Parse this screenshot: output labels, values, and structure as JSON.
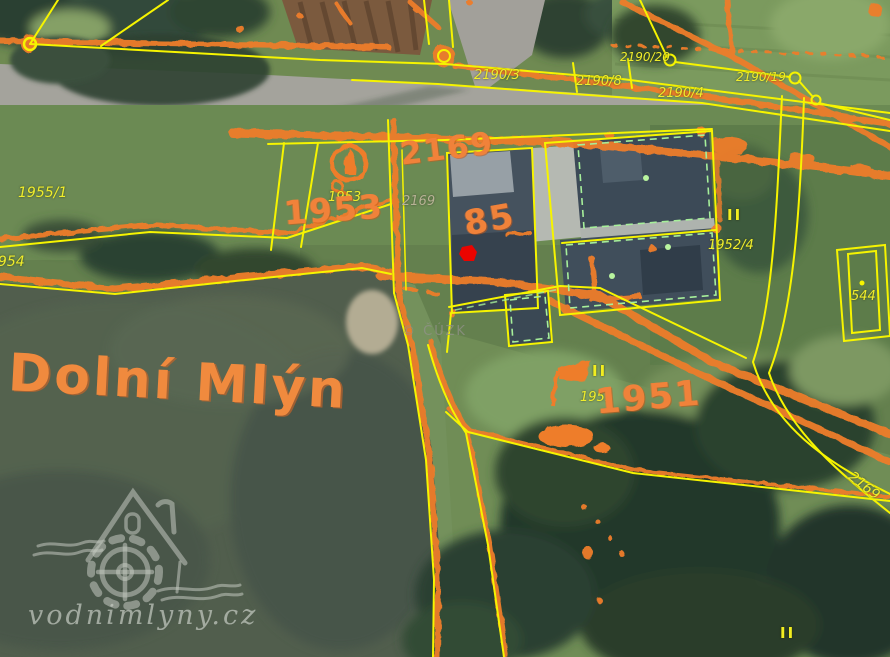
{
  "map": {
    "place_name": "Dolní Mlýn",
    "copyright": "© ČÚZK",
    "site_watermark": "vodnimlyny.cz",
    "parcels": {
      "p2190_3": "2190/3",
      "p2190_8": "2190/8",
      "p2190_20": "2190/20",
      "p2190_19": "2190/19",
      "p2190_4": "2190/4",
      "p1955_1": "1955/1",
      "p1954": "1954",
      "p1953_small": "1953",
      "p1953_big": "1953",
      "p2169_big": "2169",
      "p2169_small": "2169",
      "p2169_edge": "2169",
      "p1952_4": "1952/4",
      "p544": "544",
      "p1951_small": "1951",
      "p1951_big": "1951",
      "building_85": "85"
    },
    "land_use_marks": {
      "mark1": "II",
      "mark2": "II",
      "mark3": "II"
    },
    "icons": {
      "red_marker": "selected-location-dot",
      "boundary_circle": "cadastral-boundary-point",
      "monument": "old-map-monument-symbol",
      "flag": "old-map-flag-symbol",
      "watermill_logo": "house-with-waterwheel"
    },
    "colors": {
      "old_map_orange": "#ee7d2c",
      "cadastre_yellow": "#f6f400",
      "building_green": "#a6ef9a",
      "marker_red": "#ea0400",
      "label_orange": "#f0823a",
      "water": "#515e4d",
      "road": "#a4a39c"
    }
  }
}
